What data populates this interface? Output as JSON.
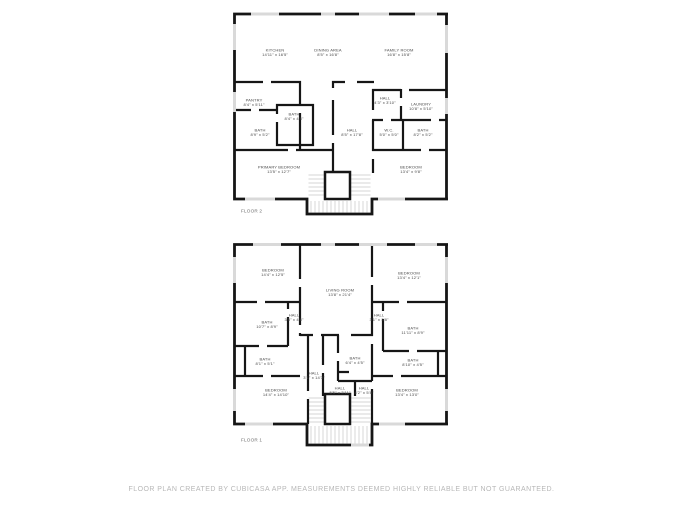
{
  "footer": {
    "text": "FLOOR PLAN CREATED BY CUBICASA APP. MEASUREMENTS DEEMED HIGHLY RELIABLE BUT NOT GUARANTEED."
  },
  "colors": {
    "wall": "#161616",
    "window": "#d9d9d9",
    "stair_tread": "#c7c7c7",
    "room_label": "#4a4a4a",
    "floor_tag": "#6e6e6e",
    "footer_text": "#b7b7b7",
    "background": "#ffffff"
  },
  "floors": [
    {
      "id": "floor-2",
      "label": "FLOOR 2",
      "rooms": [
        {
          "name": "KITCHEN",
          "dims": "14'11\" x 16'5\"",
          "x": 42,
          "y": 43
        },
        {
          "name": "DINING AREA",
          "dims": "8'5\" x 16'8\"",
          "x": 95,
          "y": 43
        },
        {
          "name": "FAMILY ROOM",
          "dims": "16'8\" x 15'8\"",
          "x": 166,
          "y": 43
        },
        {
          "name": "PANTRY",
          "dims": "8'4\" x 5'11\"",
          "x": 21,
          "y": 93
        },
        {
          "name": "BATH",
          "dims": "8'4\" x 4'8\"",
          "x": 61,
          "y": 107
        },
        {
          "name": "BATH",
          "dims": "8'9\" x 5'2\"",
          "x": 27,
          "y": 123
        },
        {
          "name": "HALL",
          "dims": "8'5\" x 17'8\"",
          "x": 119,
          "y": 123
        },
        {
          "name": "HALL",
          "dims": "4'3\" x 3'10\"",
          "x": 152,
          "y": 91
        },
        {
          "name": "LAUNDRY",
          "dims": "10'8\" x 5'10\"",
          "x": 188,
          "y": 97
        },
        {
          "name": "W.C.",
          "dims": "5'0\" x 5'0\"",
          "x": 156,
          "y": 123
        },
        {
          "name": "BATH",
          "dims": "8'2\" x 5'2\"",
          "x": 190,
          "y": 123
        },
        {
          "name": "PRIMARY BEDROOM",
          "dims": "13'5\" x 12'7\"",
          "x": 46,
          "y": 160
        },
        {
          "name": "BEDROOM",
          "dims": "13'4\" x 9'8\"",
          "x": 178,
          "y": 160
        }
      ]
    },
    {
      "id": "floor-1",
      "label": "FLOOR 1",
      "rooms": [
        {
          "name": "BEDROOM",
          "dims": "14'4\" x 12'5\"",
          "x": 40,
          "y": 32
        },
        {
          "name": "LIVING ROOM",
          "dims": "13'8\" x 21'4\"",
          "x": 107,
          "y": 52
        },
        {
          "name": "BEDROOM",
          "dims": "13'4\" x 12'1\"",
          "x": 176,
          "y": 35
        },
        {
          "name": "BATH",
          "dims": "10'7\" x 8'9\"",
          "x": 34,
          "y": 84
        },
        {
          "name": "HALL",
          "dims": "3'5\" x 4'8\"",
          "x": 61,
          "y": 77
        },
        {
          "name": "HALL",
          "dims": "3'1\" x 3'8\"",
          "x": 146,
          "y": 77
        },
        {
          "name": "BATH",
          "dims": "11'11\" x 8'9\"",
          "x": 180,
          "y": 90
        },
        {
          "name": "BATH",
          "dims": "8'1\" x 5'1\"",
          "x": 32,
          "y": 121
        },
        {
          "name": "BATH",
          "dims": "6'4\" x 4'5\"",
          "x": 122,
          "y": 120
        },
        {
          "name": "BATH",
          "dims": "8'10\" x 4'5\"",
          "x": 180,
          "y": 122
        },
        {
          "name": "HALL",
          "dims": "3'1\" x 14'3\"",
          "x": 81,
          "y": 135
        },
        {
          "name": "HALL",
          "dims": "5'5\" x 3'11\"",
          "x": 107,
          "y": 150
        },
        {
          "name": "HALL",
          "dims": "4'2\" x 5'8\"",
          "x": 131,
          "y": 150
        },
        {
          "name": "BEDROOM",
          "dims": "14'4\" x 14'10\"",
          "x": 43,
          "y": 152
        },
        {
          "name": "BEDROOM",
          "dims": "13'4\" x 13'0\"",
          "x": 174,
          "y": 152
        }
      ]
    }
  ]
}
